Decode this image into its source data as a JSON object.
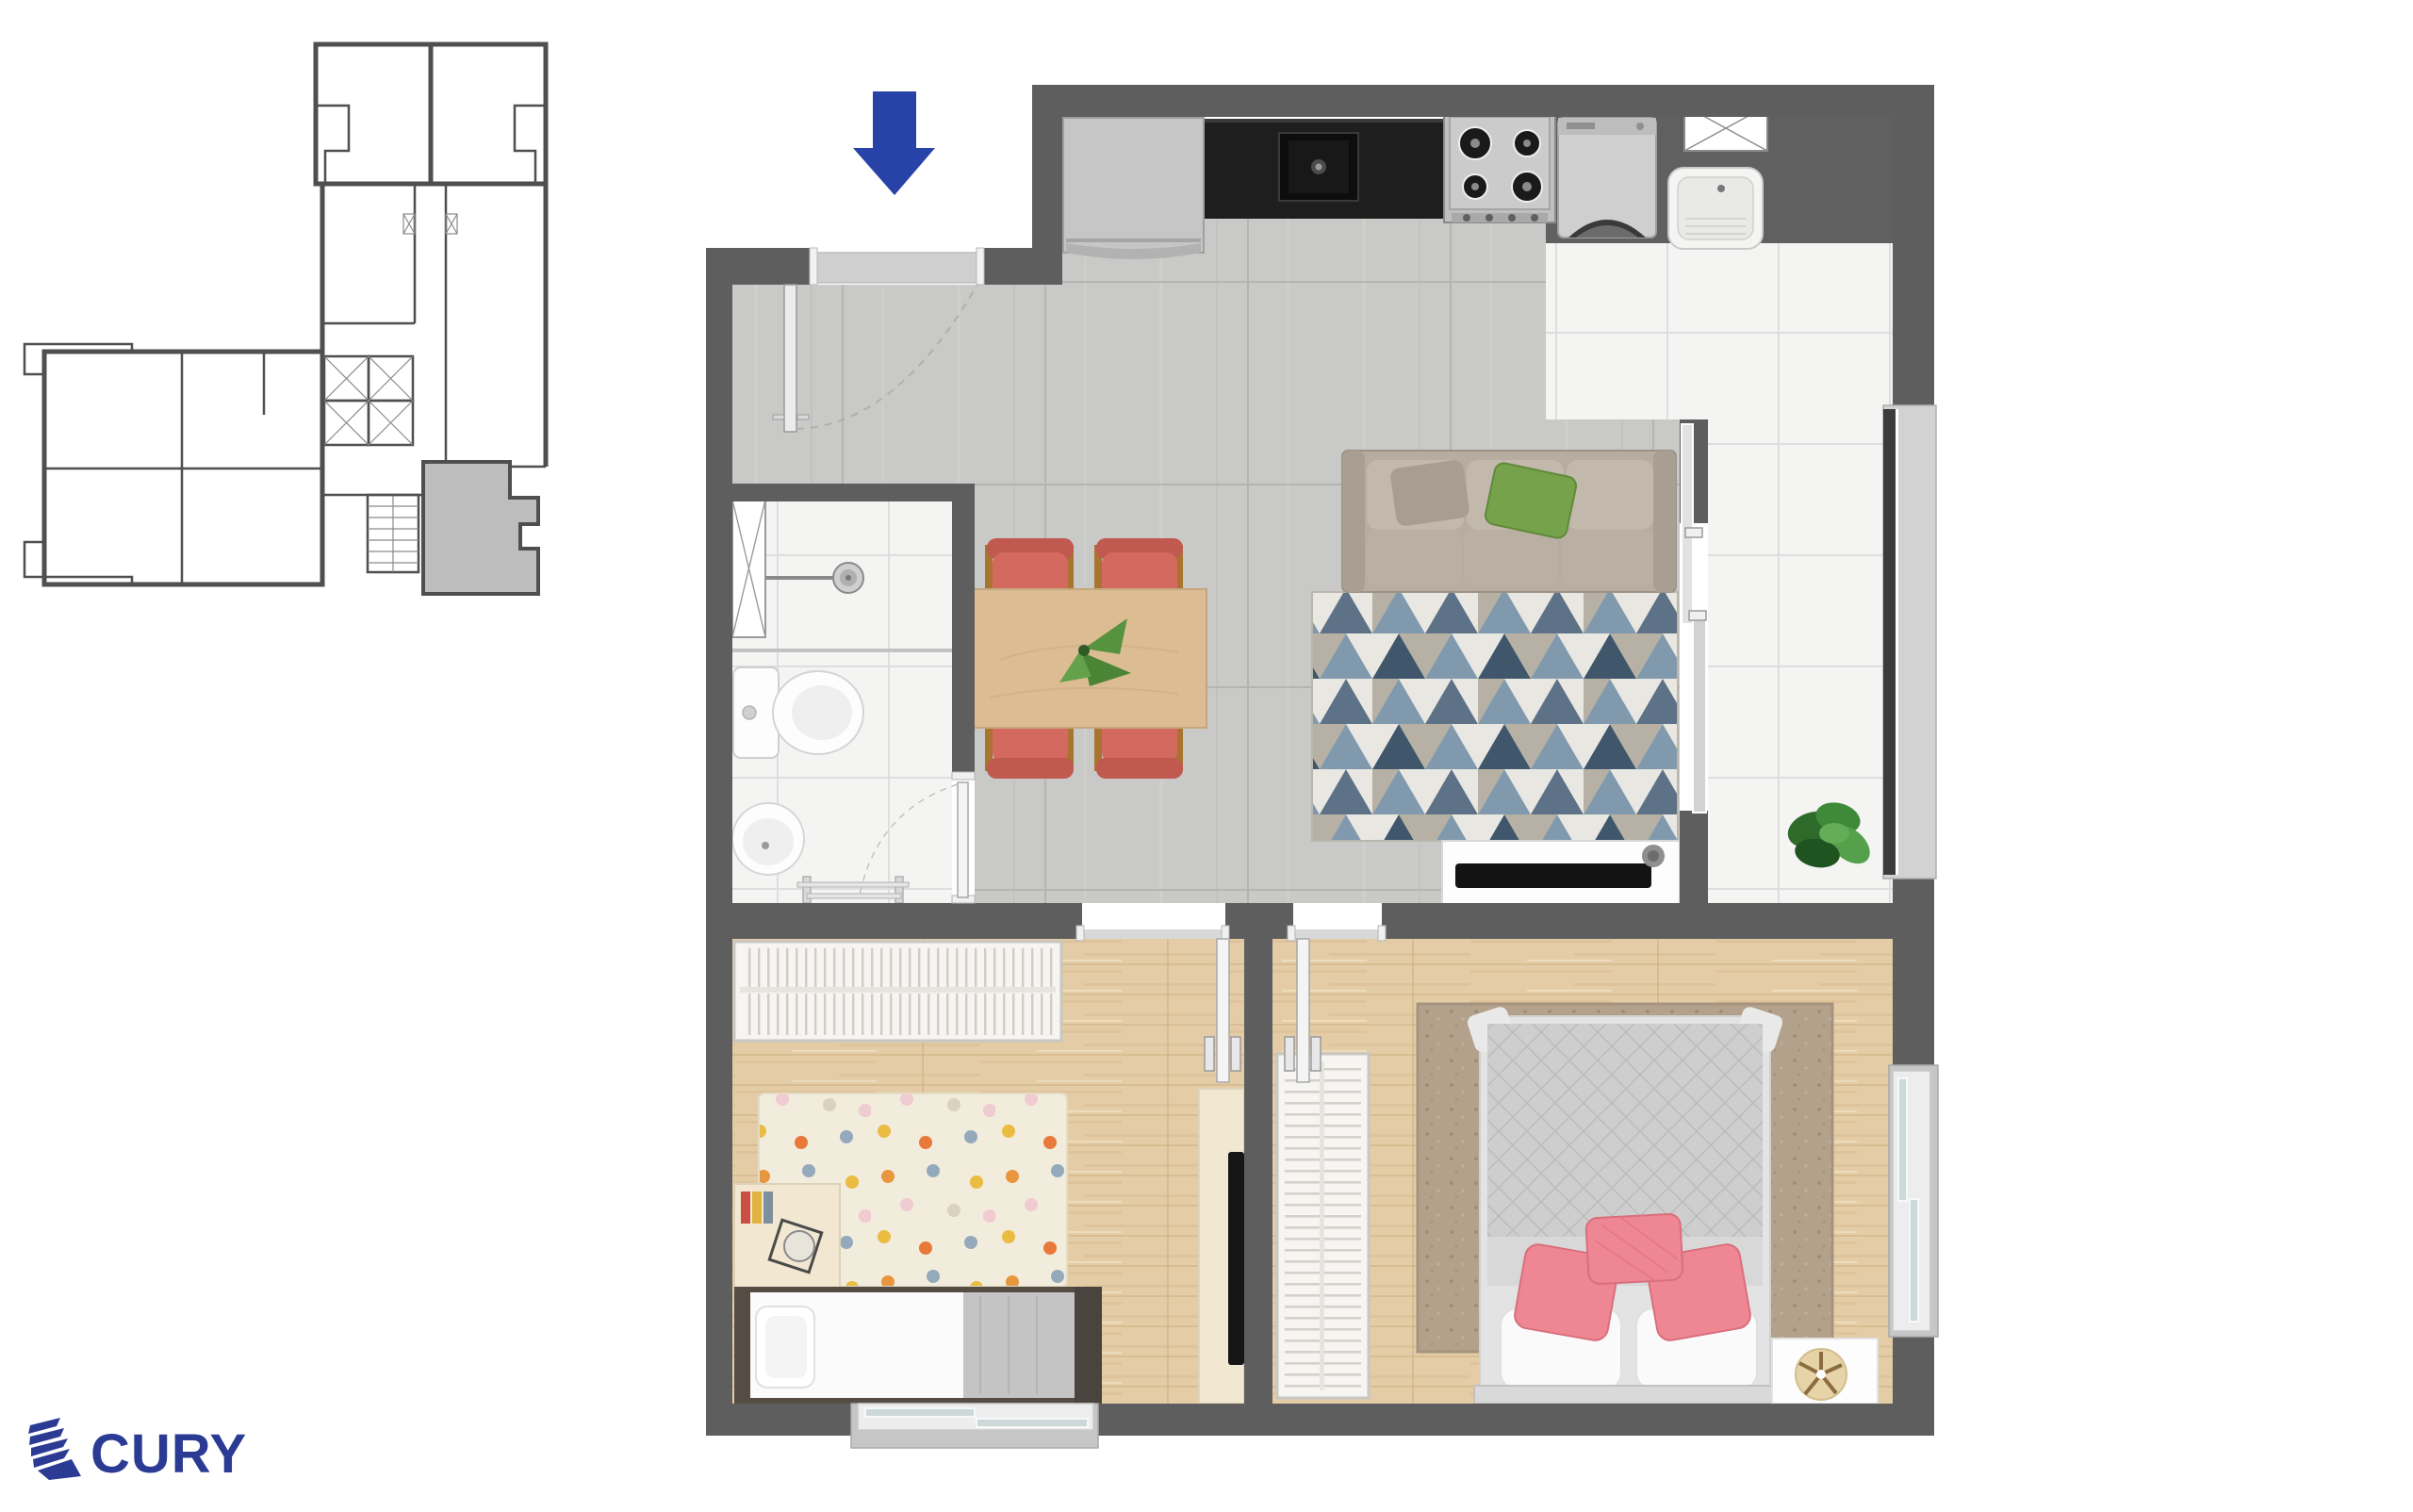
{
  "brand": {
    "name": "CURY"
  },
  "floor_plan": {
    "type": "apartment-top-view-render",
    "entrance_arrow_direction": "down",
    "rooms": [
      "entry",
      "kitchen",
      "living-dining",
      "bathroom",
      "service-area",
      "bedroom-1",
      "bedroom-2"
    ],
    "fixtures": [
      "entrance-door",
      "refrigerator",
      "kitchen-counter-sink",
      "gas-cooktop",
      "washing-machine",
      "laundry-tank",
      "duct-shaft",
      "shower",
      "toilet",
      "round-washbasin",
      "towel-bar",
      "dining-table",
      "dining-chair",
      "fern-plant",
      "sofa",
      "triangle-rug",
      "tv-rack",
      "sliding-glass-door",
      "service-window",
      "potted-plant",
      "wardrobe",
      "study-desk",
      "polka-dot-rug",
      "single-bed",
      "tv-panel",
      "double-bed",
      "shag-rug",
      "nightstand",
      "round-stool",
      "bedroom-window"
    ]
  },
  "key_plan": {
    "type": "building-floor-key-plan",
    "highlighted_unit": "bottom-right-of-core"
  },
  "colors": {
    "wall": "#5e5e5e",
    "floorTile": "#c9c9c7",
    "grout": "#b4b4b2",
    "woodFloor": "#e4cda6",
    "woodStreak": "#d8bc91",
    "whiteTile": "#f4f4f3",
    "whiteGrout": "#dedede",
    "counter": "#1e1e1e",
    "accentBlue": "#2843a8",
    "logoBlue": "#2b3b94",
    "keyHighlight": "#bdbdbd",
    "keyStroke": "#4f4f4f",
    "sofa": "#b6ac9f",
    "sofaCushion": "#c2b8ab",
    "pillowGreen": "#76a24b",
    "rugNavy": "#3f566b",
    "rugSteel": "#8099ad",
    "rugLight": "#e9e7e1",
    "rugTaupe": "#b7b0a5",
    "rugMid": "#5d7286",
    "diningWood": "#dcbd93",
    "chairCoral": "#d3695f",
    "chairCoralDark": "#c05a50",
    "polkaBg": "#f2ecdc",
    "shag": "#b3a18c",
    "quilt": "#cecece",
    "pillowPink": "#ee8793",
    "wardrobe": "#f6f5f2",
    "dresser": "#f2e8d2",
    "bedFrame": "#554c44"
  }
}
